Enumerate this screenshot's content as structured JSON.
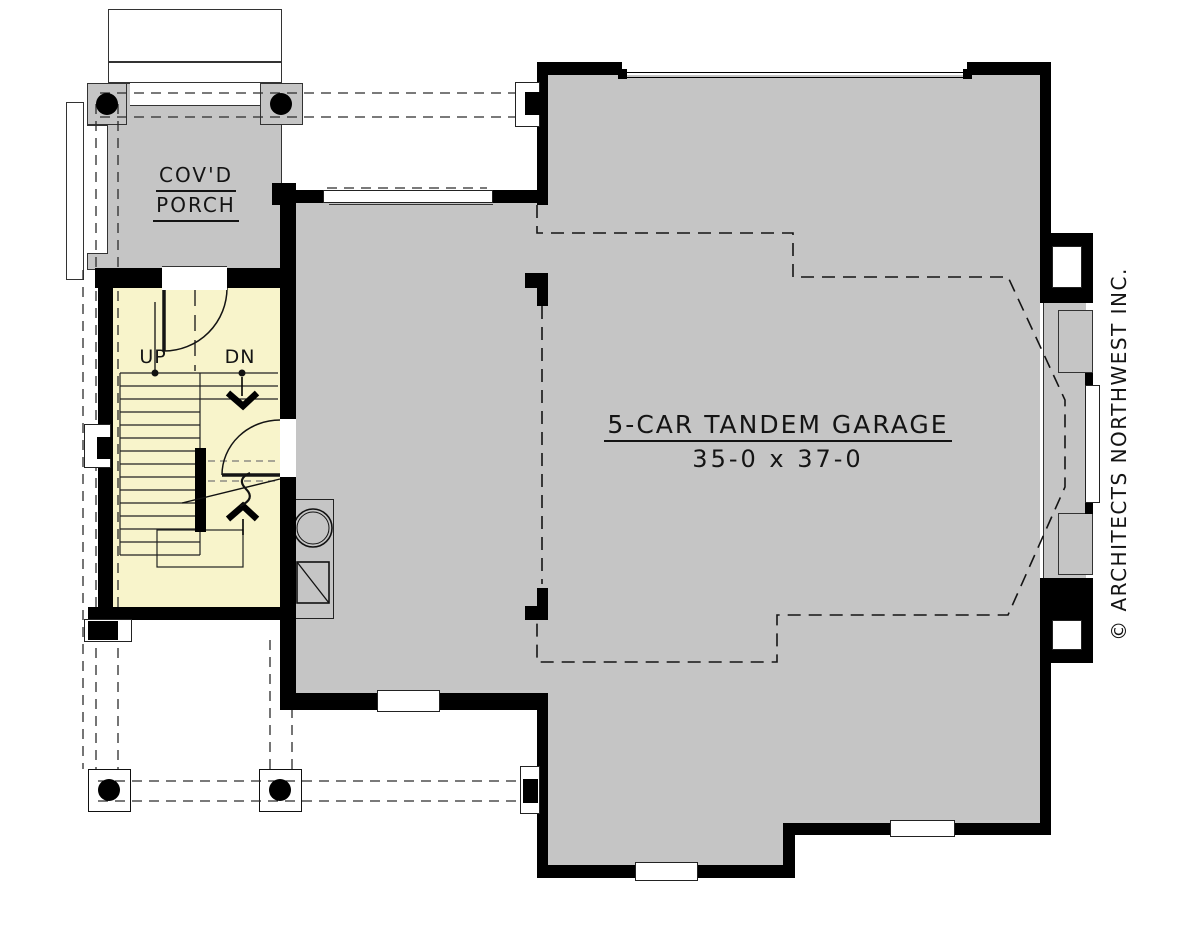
{
  "plan": {
    "rooms": {
      "porch": {
        "label_line1": "COV'D",
        "label_line2": "PORCH"
      },
      "garage": {
        "name": "5-CAR TANDEM GARAGE",
        "dimensions": "35-0 x 37-0"
      },
      "stairs": {
        "up": "UP",
        "down": "DN"
      }
    },
    "copyright": "© ARCHITECTS NORTHWEST INC.",
    "colors": {
      "wall": "#000000",
      "floor_gray": "#c5c5c5",
      "stairs_yellow": "#f8f4cb",
      "background": "#ffffff",
      "line": "#1a1a1a"
    },
    "icons": {
      "water_heater": "water-heater-icon",
      "furnace": "furnace-icon",
      "porch_column": "structural-column-icon"
    }
  }
}
